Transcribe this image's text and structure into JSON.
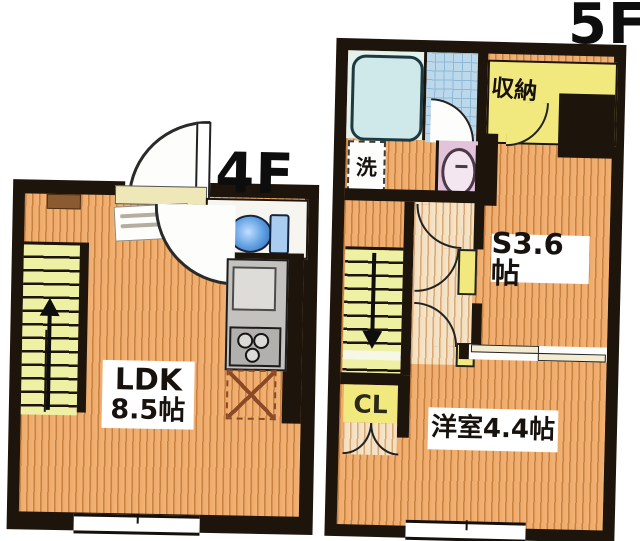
{
  "floors": {
    "f4": {
      "label": "4F",
      "rooms": {
        "ldk": {
          "name": "LDK",
          "size": "8.5帖"
        }
      }
    },
    "f5": {
      "label": "5F",
      "rooms": {
        "service": {
          "name": "S3.6帖"
        },
        "western": {
          "name": "洋室4.4帖"
        },
        "storage": {
          "name": "収納"
        },
        "closet": {
          "name": "CL"
        },
        "laundry": {
          "name": "洗"
        }
      }
    }
  },
  "colors": {
    "wall": "#1d140c",
    "wood_floor": "#edaa6a",
    "hall_floor": "#f2ddbd",
    "stairs": "#eef0a4",
    "storage_yellow": "#f2e97e",
    "bathtub": "#cfe8ea",
    "bath_tile": "#bcd9ec",
    "toilet_blue": "#4a90d9",
    "washbasin_pink": "#e3c3dc",
    "kitchen_gray": "#c4c2be"
  }
}
